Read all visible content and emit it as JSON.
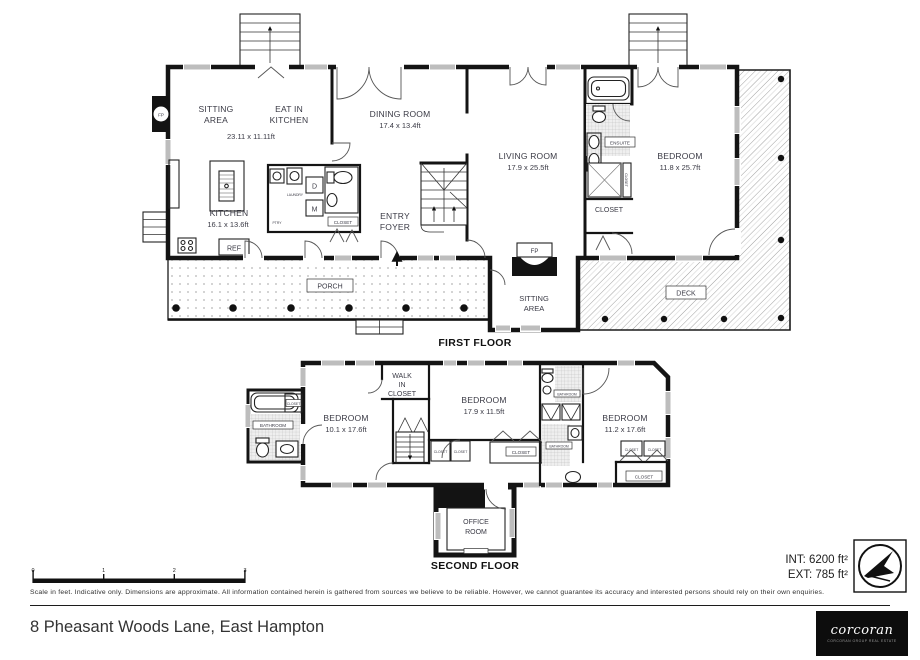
{
  "address": "8 Pheasant Woods Lane, East Hampton",
  "footer": {
    "disclaimer": "Scale in feet. Indicative only. Dimensions are approximate. All information contained herein is gathered from sources we believe to be reliable. However, we cannot guarantee its accuracy and interested persons should rely on their own enquiries.",
    "int_area": "INT: 6200 ft²",
    "ext_area": "EXT: 785 ft²",
    "scale_ticks": [
      "0",
      "1",
      "2",
      "3"
    ],
    "logo": {
      "name": "corcoran",
      "tagline": "corcoran group real estate"
    }
  },
  "colors": {
    "ink": "#141414",
    "label": "#3a3a45",
    "window": "#bdbdbd"
  },
  "first_floor": {
    "title": "FIRST FLOOR",
    "sitting_area": {
      "l1": "SITTING",
      "l2": "AREA",
      "dims": "23.11 x 11.11ft"
    },
    "eat_in_kitchen": {
      "l1": "EAT IN",
      "l2": "KITCHEN"
    },
    "dining_room": {
      "name": "DINING ROOM",
      "dims": "17.4 x 13.4ft"
    },
    "living_room": {
      "name": "LIVING ROOM",
      "dims": "17.9 x 25.5ft"
    },
    "bedroom": {
      "name": "BEDROOM",
      "dims": "11.8 x 25.7ft"
    },
    "kitchen": {
      "name": "KITCHEN",
      "dims": "16.1 x 13.6ft"
    },
    "entry_foyer": {
      "l1": "ENTRY",
      "l2": "FOYER"
    },
    "porch": "PORCH",
    "deck": "DECK",
    "sitting_area_2": {
      "l1": "SITTING",
      "l2": "AREA"
    },
    "ensuite": "ENSUITE",
    "closet_bedroom": "CLOSET",
    "closet_hall": "CLOSET",
    "closet_micro": "CLOSET",
    "laundry": "LAUNDRY",
    "pantry": "PTRY",
    "dryer": "D",
    "washer": "M",
    "fridge": "REF",
    "fireplace_left": "FP",
    "fireplace_sitting": "FP"
  },
  "second_floor": {
    "title": "SECOND FLOOR",
    "walk_in_closet": {
      "l1": "WALK",
      "l2": "IN",
      "l3": "CLOSET"
    },
    "bedroom1": {
      "name": "BEDROOM",
      "dims": "10.1 x 17.6ft"
    },
    "bedroom2": {
      "name": "BEDROOM",
      "dims": "17.9 x 11.5ft"
    },
    "bedroom3": {
      "name": "BEDROOM",
      "dims": "11.2 x 17.6ft"
    },
    "bathroom_left": "BATHROOM",
    "bathroom_top": "BATHROOM",
    "bathroom_bottom": "BATHROOM",
    "office": {
      "l1": "OFFICE",
      "l2": "ROOM"
    },
    "closets": {
      "bath": "CLOSET",
      "hall1": "CLOSET",
      "hall2": "CLOSET",
      "bed2": "CLOSET",
      "bed3a": "CLOSET",
      "bed3b": "CLOSET",
      "bed3": "CLOSET"
    }
  }
}
